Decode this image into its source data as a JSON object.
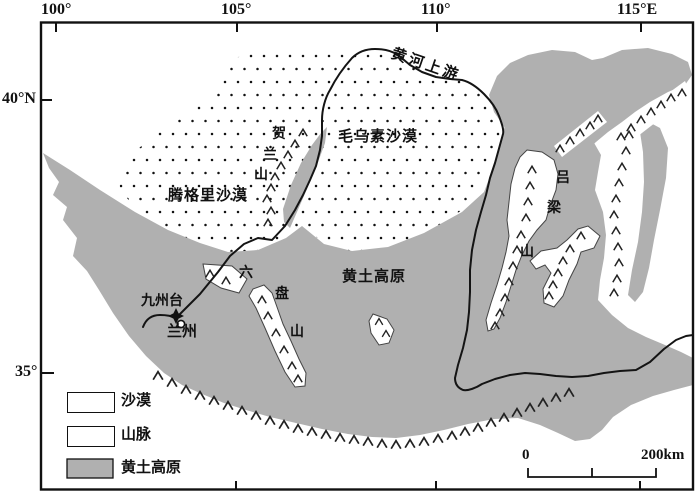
{
  "map": {
    "axis": {
      "top_ticks": [
        "100°",
        "105°",
        "110°",
        "115°E"
      ],
      "left_ticks": [
        "40°N",
        "35°"
      ]
    },
    "labels": {
      "yellow_river_upper": "黄河上游",
      "mu_us_desert": "毛乌素沙漠",
      "tengger_desert": "腾格里沙漠",
      "helan_mtn_chars": [
        "贺",
        "兰",
        "山"
      ],
      "luliang_mtn_chars": [
        "吕",
        "梁",
        "山"
      ],
      "liupan_mtn_chars": [
        "六",
        "盘",
        "山"
      ],
      "loess_plateau": "黄土高原",
      "jiuzhoutai": "九州台",
      "lanzhou": "兰州"
    },
    "legend": [
      {
        "key": "desert",
        "label": "沙漠"
      },
      {
        "key": "mountains",
        "label": "山脉"
      },
      {
        "key": "loess_plateau",
        "label": "黄土高原"
      }
    ],
    "scale_bar": {
      "start": "0",
      "end": "200km"
    },
    "colors": {
      "plateau_gray": "#b0b0b0",
      "line_black": "#141414"
    }
  }
}
